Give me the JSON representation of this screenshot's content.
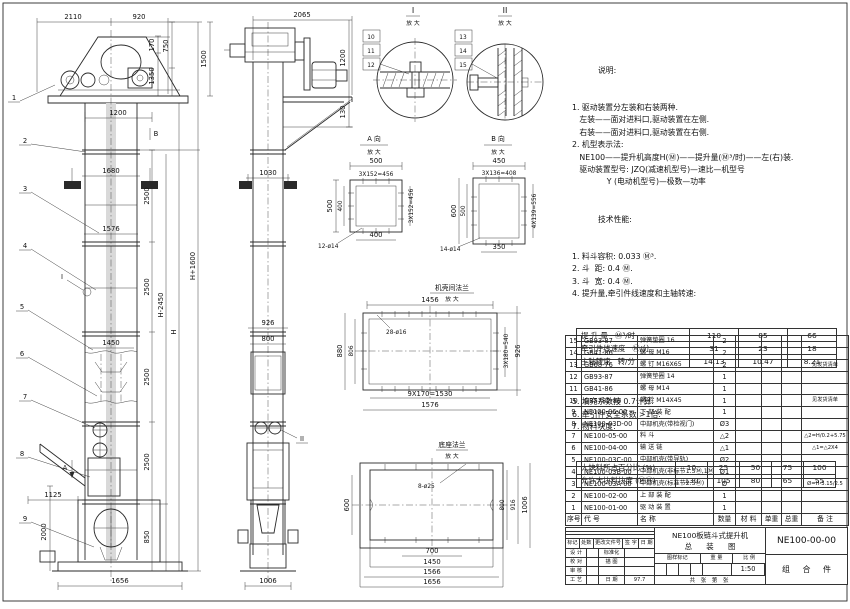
{
  "views": {
    "front": {
      "dims": {
        "w2110": "2110",
        "w920": "920",
        "h170": "170",
        "h750": "750",
        "h1350": "1350",
        "h1500": "1500",
        "w1200": "1200",
        "w1680": "1680",
        "w1576": "1576",
        "w1450": "1450",
        "s2500": "2500",
        "hm": "H-2450",
        "h": "H",
        "hp": "H+1600",
        "w1125": "1125",
        "h2000": "2000",
        "h850": "850",
        "w1656": "1656"
      },
      "marks": {
        "a": "A",
        "b": "B",
        "i": "I"
      },
      "balloons": [
        "1",
        "2",
        "3",
        "4",
        "5",
        "6",
        "7",
        "8",
        "9"
      ]
    },
    "side": {
      "dims": {
        "w2065": "2065",
        "h1200": "1200",
        "h130": "130",
        "w1030": "1030",
        "w926": "926",
        "w800": "800",
        "w1006": "1006"
      },
      "marks": {
        "ii": "II"
      }
    },
    "detail1": {
      "title": "I",
      "sub": "放 大",
      "balloons": [
        "10",
        "11",
        "12"
      ]
    },
    "detail2": {
      "title": "II",
      "sub": "放 大",
      "balloons": [
        "13",
        "14",
        "15"
      ]
    },
    "view_a": {
      "title": "A 向",
      "sub": "放 大",
      "top": "500",
      "top2": "3X152=456",
      "left": "500",
      "left2": "400",
      "right": "3X152=456",
      "bottom": "400",
      "holes": "12-ø14"
    },
    "view_b": {
      "title": "B 向",
      "sub": "放 大",
      "top": "450",
      "top2": "3X136=408",
      "left": "600",
      "left2": "500",
      "right": "4X139=556",
      "bottom": "350",
      "holes": "14-ø14"
    },
    "flange": {
      "title": "机壳间法兰",
      "sub": "放 大",
      "top": "1456",
      "left1": "880",
      "left2": "806",
      "right1": "3X180=540",
      "right2": "926",
      "bottom1": "9X170=1530",
      "bottom2": "1576",
      "holes": "28-ø16"
    },
    "base": {
      "title": "底座法兰",
      "sub": "放 大",
      "left": "600",
      "right1": "800",
      "right2": "916",
      "right3": "1006",
      "bottom1": "700",
      "bottom2": "1450",
      "bottom3": "1566",
      "bottom4": "1656",
      "holes": "8-ø25"
    }
  },
  "notes": {
    "title": "说明:",
    "lines": [
      "1. 驱动装置分左装和右装两种.",
      "   左装——面对进料口,驱动装置在左侧.",
      "   右装——面对进料口,驱动装置在右侧.",
      "2. 机型表示法:",
      "   NE100——提升机高度H(Ⓜ)——提升量(Ⓜ³/时)——左(右)装.",
      "   驱动装置型号: JZQ(减速机型号)—速比—机型号",
      "              Y (电动机型号)—极数—功率"
    ]
  },
  "tech": {
    "title": "技术性能:",
    "before": [
      "1. 料斗容积: 0.033 Ⓜ³.",
      "2. 斗  距: 0.4 Ⓜ.",
      "3. 斗  宽: 0.4 Ⓜ.",
      "4. 提升量,牵引件线速度和主轴转速:"
    ],
    "speed_rows": [
      [
        "提 升 量   Ⓜ³/时",
        "110",
        "85",
        "66"
      ],
      [
        "牵引件线速度   Ⓜ/分",
        "31",
        "23",
        "18"
      ],
      [
        "主轴转速   转/分",
        "14.13",
        "10.47",
        "8.21"
      ]
    ],
    "after": [
      "5. 填充系数按 0.7计算.",
      "6. 牵引件安全系数 >1倍.",
      "7. 物料块度:"
    ],
    "lump_rows": [
      [
        "大块料所占百分比 (%)",
        "10",
        "25",
        "50",
        "75",
        "100"
      ],
      [
        "允许大块料块度 (ⓂⓂ)",
        "130",
        "105",
        "80",
        "65",
        "55"
      ]
    ]
  },
  "bom": {
    "headers": [
      "序号",
      "代    号",
      "名    称",
      "数量",
      "材 料",
      "单重",
      "总重",
      "备  注"
    ],
    "rows": [
      [
        "15",
        "GB93-87",
        "弹簧垫圈  16",
        "2",
        "",
        "",
        "",
        ""
      ],
      [
        "14",
        "GB41-86",
        "螺 母  M16",
        "2",
        "",
        "",
        "",
        ""
      ],
      [
        "13",
        "GB68-76",
        "螺 钉  M16X65",
        "2",
        "",
        "",
        "",
        "见发货清单"
      ],
      [
        "12",
        "GB93-87",
        "弹簧垫圈  14",
        "1",
        "",
        "",
        "",
        ""
      ],
      [
        "11",
        "GB41-86",
        "螺 母  M14",
        "1",
        "",
        "",
        "",
        ""
      ],
      [
        "10",
        "GB5782-86",
        "螺 栓  M14X45",
        "1",
        "",
        "",
        "",
        "见发货清单"
      ],
      [
        "9",
        "NE100-06-00",
        "下 部 装 配",
        "1",
        "",
        "",
        "",
        ""
      ],
      [
        "8",
        "NE100-03D-00",
        "中部机壳(带检视门)",
        "Ø3",
        "",
        "",
        "",
        ""
      ],
      [
        "7",
        "NE100-05-00",
        "料  斗",
        "△2",
        "",
        "",
        "",
        "△2=H/0.2+5.75"
      ],
      [
        "6",
        "NE100-04-00",
        "输 送 链",
        "△1",
        "",
        "",
        "",
        "△1=△2X4"
      ],
      [
        "5",
        "NE100-03C-00",
        "中部机壳(带导轨)",
        "Ø2",
        "",
        "",
        "",
        ""
      ],
      [
        "4",
        "NE100-03B-00",
        "中部机壳(非标节1.5Ⓜ,1Ⓜ)",
        "Ø1",
        "",
        "",
        "",
        ""
      ],
      [
        "3",
        "NE100-03A-00",
        "中部机壳(标准节2.5Ⓜ)",
        "Ø",
        "",
        "",
        "",
        "Ø=H-3.15/2.5"
      ],
      [
        "2",
        "NE100-02-00",
        "上 部 装 配",
        "1",
        "",
        "",
        "",
        ""
      ],
      [
        "1",
        "NE100-01-00",
        "驱 动 装 置",
        "1",
        "",
        "",
        "",
        ""
      ]
    ]
  },
  "titleblock": {
    "rev_headers": [
      "标记",
      "处数",
      "更改文件号",
      "签 字",
      "日 期"
    ],
    "left_rows": [
      [
        "设 计",
        "",
        "标准化",
        ""
      ],
      [
        "校 对",
        "",
        "描 图",
        ""
      ],
      [
        "审 核",
        "",
        "",
        ""
      ],
      [
        "工 艺",
        "",
        "日 期",
        "97.7"
      ]
    ],
    "title_line1": "NE100板链斗式提升机",
    "title_line2": "总 装 图",
    "stamp_headers": [
      "图样标记",
      "重 量",
      "比 例"
    ],
    "scale": "1:50",
    "sheet_label": "共  张  第  张",
    "drawing_no": "NE100-00-00",
    "part_kind": "组 合 件"
  }
}
